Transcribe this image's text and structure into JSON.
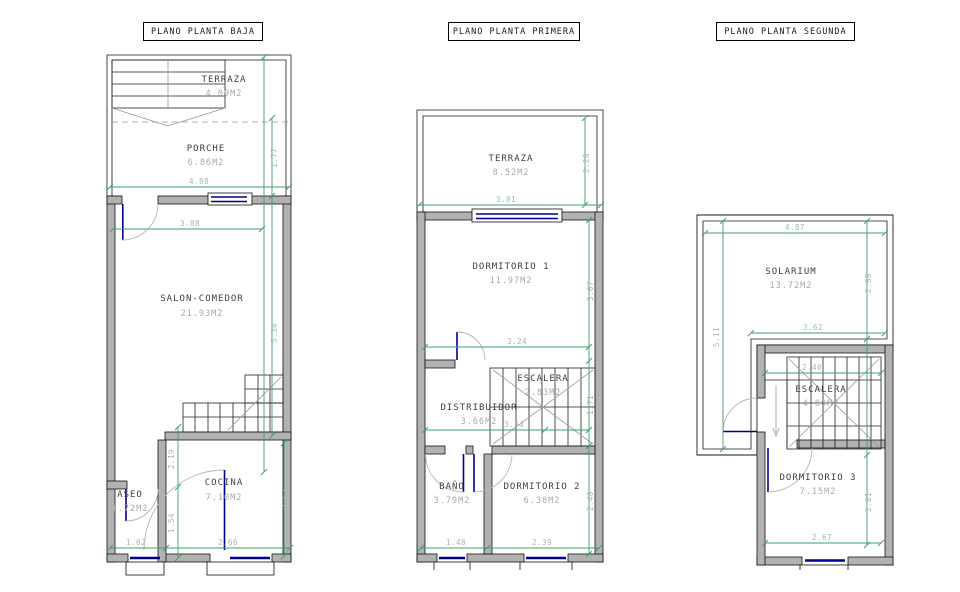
{
  "sheet": {
    "kind": "architectural floor plans",
    "units": "M2"
  },
  "colors": {
    "dimension_line": "#3da06e",
    "dimension_text": "#a3b8a8",
    "wall_fill": "#b2b2b2",
    "window_blue": "#00008f",
    "room_name_text": "#3f3f3f",
    "room_area_text": "#a9a9a9"
  },
  "plans": {
    "baja": {
      "title": "PLANO PLANTA BAJA",
      "rooms": {
        "terraza": {
          "name": "TERRAZA",
          "area": "4.09M2"
        },
        "porche": {
          "name": "PORCHE",
          "area": "6.86M2"
        },
        "salon": {
          "name": "SALON-COMEDOR",
          "area": "21.93M2"
        },
        "aseo": {
          "name": "ASEO",
          "area": "1.72M2"
        },
        "cocina": {
          "name": "COCINA",
          "area": "7.10M2"
        }
      },
      "dims": {
        "porch_width": "4.88",
        "porch_depth": "1.77",
        "salon_width": "3.88",
        "salon_depth": "5.38",
        "hall_depth": "2.19",
        "aseo_depth": "1.54",
        "cocina_depth": "2.67",
        "aseo_width": "1.02",
        "cocina_width": "2.66"
      }
    },
    "primera": {
      "title": "PLANO PLANTA PRIMERA",
      "rooms": {
        "terraza": {
          "name": "TERRAZA",
          "area": "8.52M2"
        },
        "dormitorio1": {
          "name": "DORMITORIO 1",
          "area": "11.97M2"
        },
        "escalera": {
          "name": "ESCALERA",
          "area": "2.83M2"
        },
        "distribuidor": {
          "name": "DISTRIBUIDOR",
          "area": "3.66M2"
        },
        "bano": {
          "name": "BAÑO",
          "area": "3.79M2"
        },
        "dormitorio2": {
          "name": "DORMITORIO 2",
          "area": "6.38M2"
        }
      },
      "dims": {
        "terraza_width": "3.81",
        "terraza_depth": "2.28",
        "dorm1_width": "3.24",
        "dorm1_depth": "3.07",
        "distribuidor_width": "3.34",
        "escalera_depth": "1.71",
        "bano_width": "1.48",
        "dorm2_width": "2.39",
        "dorm2_depth": "2.40"
      }
    },
    "segunda": {
      "title": "PLANO PLANTA SEGUNDA",
      "rooms": {
        "solarium": {
          "name": "SOLARIUM",
          "area": "13.72M2"
        },
        "escalera": {
          "name": "ESCALERA",
          "area": "4.80M2"
        },
        "dormitorio3": {
          "name": "DORMITORIO 3",
          "area": "7.15M2"
        }
      },
      "dims": {
        "solarium_width": "4.87",
        "solarium_inner_width": "3.62",
        "solarium_depth_left": "5.11",
        "solarium_depth_right": "2.88",
        "escalera_width": "2.40",
        "dorm3_width": "2.67",
        "dorm3_depth": "2.81"
      }
    }
  }
}
